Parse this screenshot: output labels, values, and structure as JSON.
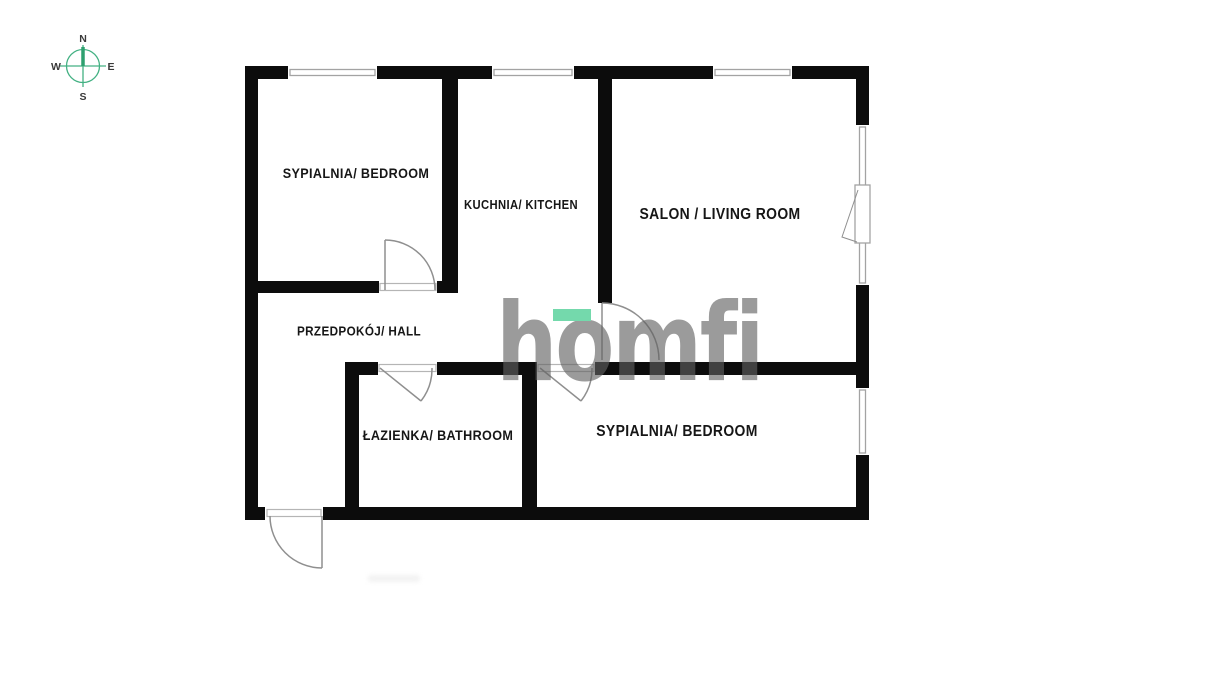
{
  "compass": {
    "north": "N",
    "south": "S",
    "east": "E",
    "west": "W"
  },
  "watermark": {
    "part1": "h",
    "part2": "o",
    "part3": "mfi"
  },
  "rooms": [
    {
      "id": "bedroom-1",
      "label": "SYPIALNIA/ BEDROOM"
    },
    {
      "id": "kitchen",
      "label": "KUCHNIA/ KITCHEN"
    },
    {
      "id": "living-room",
      "label": "SALON / LIVING ROOM"
    },
    {
      "id": "hall",
      "label": "PRZEDPOKÓJ/ HALL"
    },
    {
      "id": "bathroom",
      "label": "ŁAZIENKA/ BATHROOM"
    },
    {
      "id": "bedroom-2",
      "label": "SYPIALNIA/ BEDROOM"
    }
  ],
  "colors": {
    "wall": "#0c0c0c",
    "window_frame": "#a3a3a3",
    "door": "#8f8f8f",
    "label_text": "#161616",
    "compass_green": "#43b183",
    "compass_needle_green": "#2ea06f",
    "watermark_gray": "#9b9b9b",
    "watermark_accent": "#74d9ac"
  }
}
